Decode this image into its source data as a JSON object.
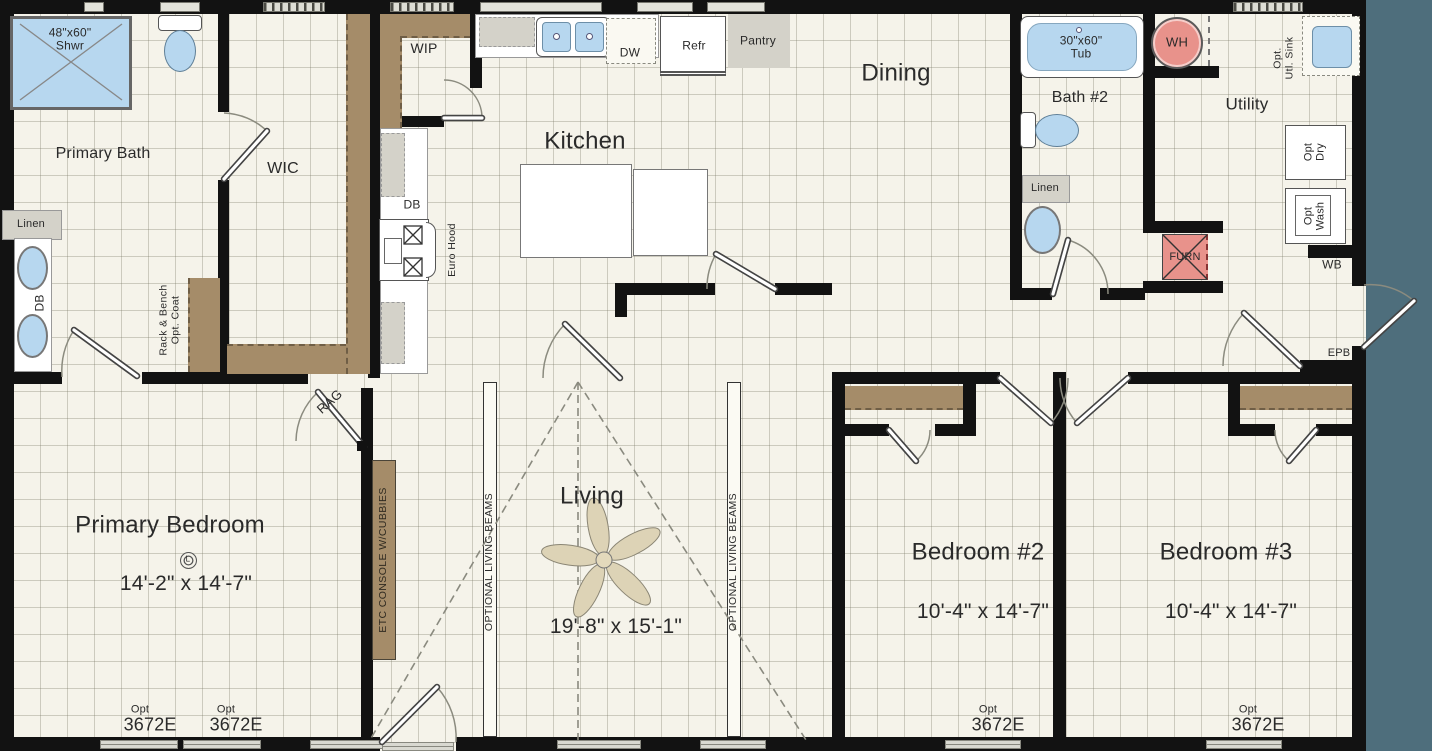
{
  "colors": {
    "background": "#4e6e7c",
    "wall": "#121212",
    "floor": "#f5f3ea",
    "shelf_brown": "#a58c69",
    "fixture_blue": "#b7d7ef",
    "accent_red": "#e8928b",
    "cabinet_gray": "#d4d2c9"
  },
  "rooms": {
    "primary_bath": {
      "label": "Primary Bath"
    },
    "wic": {
      "label": "WIC"
    },
    "wip": {
      "label": "WIP"
    },
    "kitchen": {
      "label": "Kitchen"
    },
    "dining": {
      "label": "Dining"
    },
    "bath2": {
      "label": "Bath #2"
    },
    "utility": {
      "label": "Utility"
    },
    "primary_bedroom": {
      "label": "Primary Bedroom",
      "dims": "14'-2\" x 14'-7\""
    },
    "living": {
      "label": "Living",
      "dims": "19'-8\" x 15'-1\"",
      "beam_label": "OPTIONAL LIVING BEAMS"
    },
    "bedroom2": {
      "label": "Bedroom #2",
      "dims": "10'-4\" x 14'-7\""
    },
    "bedroom3": {
      "label": "Bedroom #3",
      "dims": "10'-4\" x 14'-7\""
    }
  },
  "fixtures": {
    "shower": "48\"x60\"\nShwr",
    "tub": "30\"x60\"\nTub",
    "water_heater": "WH",
    "furnace": "FURN",
    "dishwasher": "DW",
    "refrigerator": "Refr",
    "pantry": "Pantry",
    "linen": "Linen",
    "double_bowl": "DB",
    "euro_hood": "Euro Hood",
    "opt_utility_sink": "Opt.\nUtl. Sink",
    "opt_dryer": "Opt\nDry",
    "opt_washer": "Opt\nWash",
    "wb": "WB",
    "epb": "EPB",
    "return_air_grille": "RAG",
    "coat_rack": "Rack & Bench\nOpt. Coat",
    "etc_console": "ETC CONSOLE W/CUBBIES",
    "light": "L"
  },
  "windows": {
    "opt_label": "Opt\n3672E"
  }
}
